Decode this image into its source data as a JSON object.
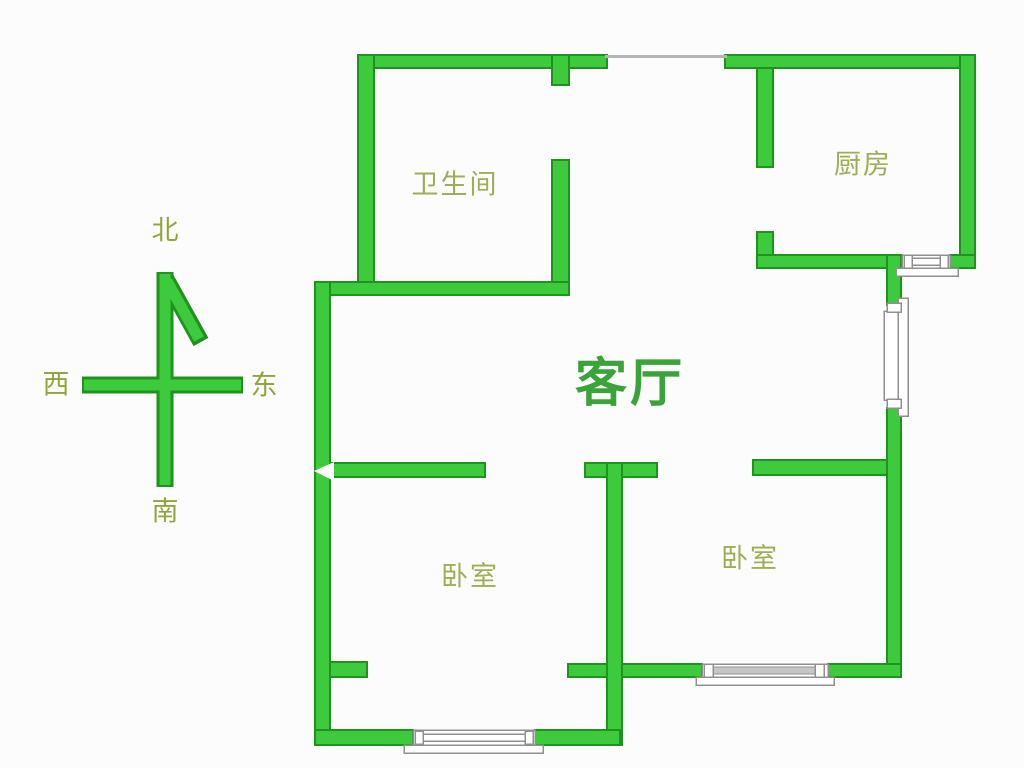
{
  "colors": {
    "background": "#fcfcfc",
    "wall_fill": "#3dcb3d",
    "wall_stroke": "#1e941e",
    "window_border": "#909090",
    "door_line": "#b5b5b5",
    "room_label": "#9fae56",
    "compass_label": "#94a43c",
    "living_room_label": "#3aa339"
  },
  "rooms": [
    {
      "name": "bathroom",
      "label": "卫生间"
    },
    {
      "name": "kitchen",
      "label": "厨房"
    },
    {
      "name": "living-room",
      "label": "客厅"
    },
    {
      "name": "bedroom-left",
      "label": "卧室"
    },
    {
      "name": "bedroom-right",
      "label": "卧室"
    }
  ],
  "compass": {
    "north": "北",
    "south": "南",
    "west": "西",
    "east": "东"
  }
}
